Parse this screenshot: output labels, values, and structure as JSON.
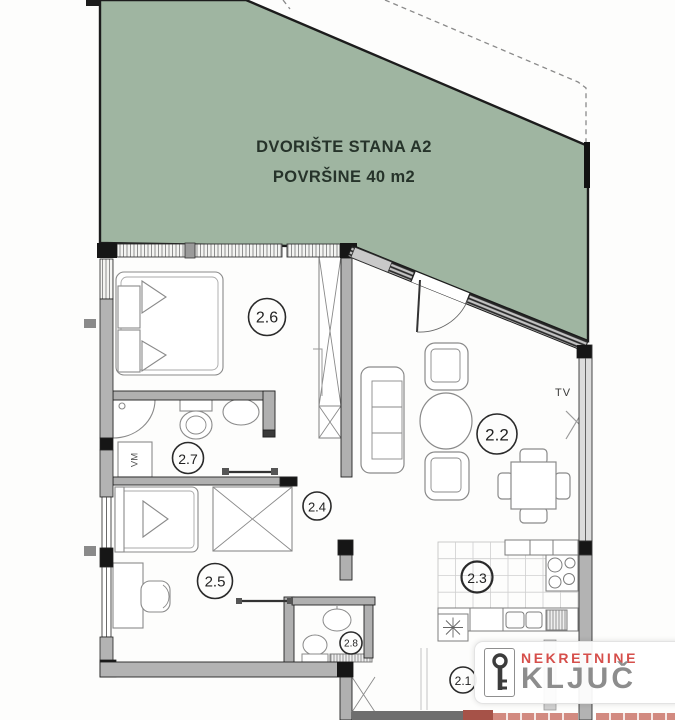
{
  "plan": {
    "courtyard_label_line1": "DVORIŠTE STANA A2",
    "courtyard_label_line2": "POVRŠINE 40 m2",
    "tv_label": "TV",
    "washing_machine_label": "VM",
    "rooms": [
      {
        "number": "2.1"
      },
      {
        "number": "2.2"
      },
      {
        "number": "2.3"
      },
      {
        "number": "2.4"
      },
      {
        "number": "2.5"
      },
      {
        "number": "2.6"
      },
      {
        "number": "2.7"
      },
      {
        "number": "2.8"
      }
    ]
  },
  "logo": {
    "brand_top": "NEKRETNINE",
    "brand_bottom": "KLJUČ"
  },
  "colors": {
    "courtyard_green": "#9fb5a1",
    "wall_gray": "#b3b3b3",
    "wall_black": "#161616",
    "furniture_line": "#8a8a8a",
    "logo_red": "#d64f4b",
    "logo_gray": "#8d8d8d",
    "red_wall": "#a65248",
    "red_wall_light": "#d28a80"
  }
}
